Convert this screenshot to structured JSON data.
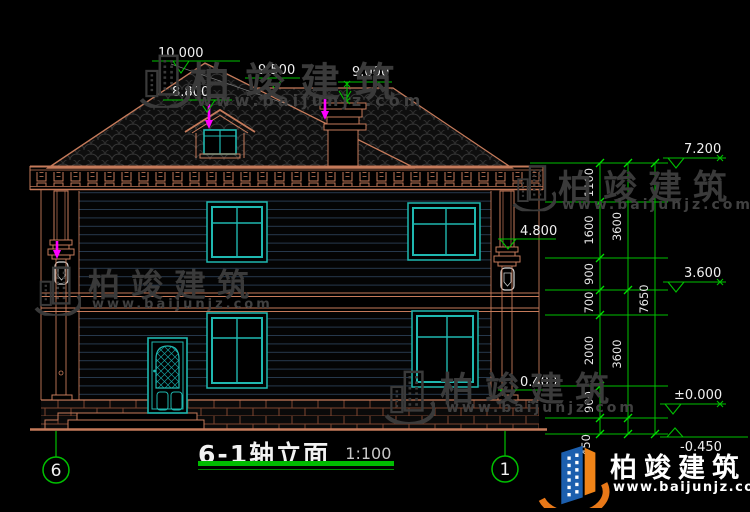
{
  "title": {
    "name": "6-1轴立面",
    "scale": "1:100"
  },
  "axis": {
    "left": "6",
    "right": "1"
  },
  "marks": {
    "ridge": "10.000",
    "hip": "9.500",
    "chimney": "9.000",
    "dormer": "8.800",
    "eave": "7.200",
    "capital": "4.800",
    "floor2": "3.600",
    "sill": "0.400",
    "zero": "±0.000",
    "ground": "-0.450"
  },
  "chain": {
    "inner": [
      "1100",
      "1600",
      "900",
      "700",
      "2000",
      "900",
      "450"
    ],
    "mid": [
      "3600",
      "3600"
    ],
    "total": "7650"
  },
  "watermark": {
    "brand": "柏竣建筑",
    "url": "www.baijunjz.com"
  },
  "brand": {
    "name": "柏竣建筑",
    "url": "www.baijunjz.com"
  },
  "colors": {
    "outline": "#C57A5A",
    "window": "#1FB8B0",
    "dimension": "#00C000",
    "text": "#F0F0F0",
    "arrow": "#FF00FF",
    "watermark": "#3A3A3A",
    "logo_blue": "#1C5FAE",
    "logo_orange": "#F08418",
    "background": "#000000"
  }
}
